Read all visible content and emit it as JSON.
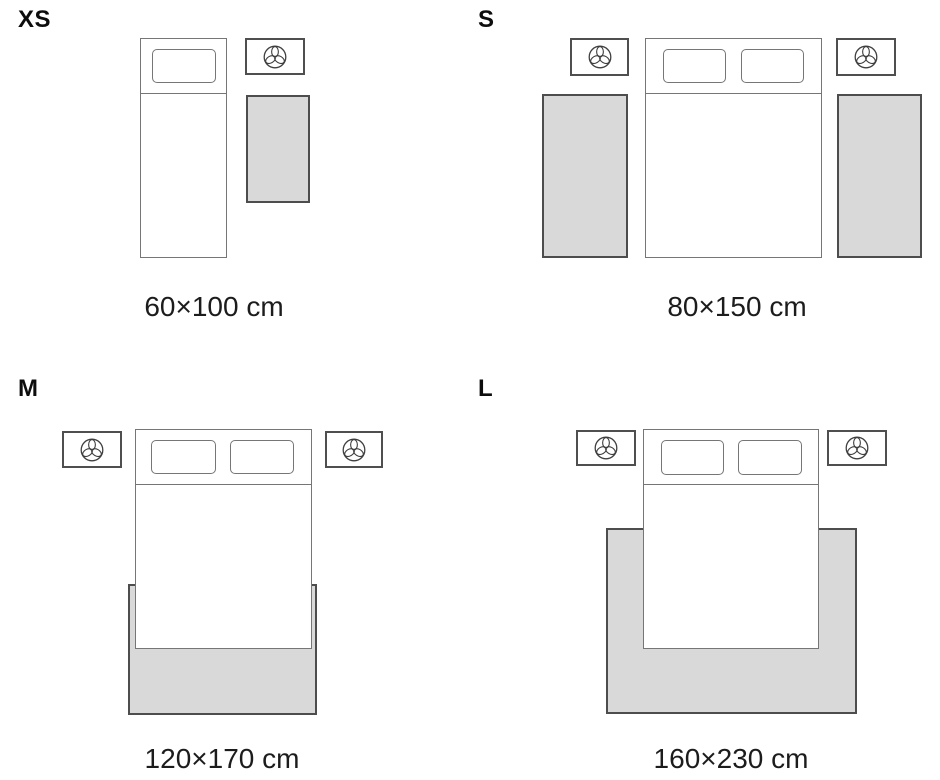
{
  "sizes": [
    {
      "id": "xs",
      "label": "XS",
      "dimensions": "60×100 cm",
      "bed_type": "single",
      "nightstands": 1,
      "rugs": 1,
      "rug_placement": "beside-bed"
    },
    {
      "id": "s",
      "label": "S",
      "dimensions": "80×150 cm",
      "bed_type": "double",
      "nightstands": 2,
      "rugs": 2,
      "rug_placement": "both-sides-of-bed"
    },
    {
      "id": "m",
      "label": "M",
      "dimensions": "120×170 cm",
      "bed_type": "double",
      "nightstands": 2,
      "rugs": 1,
      "rug_placement": "under-foot-of-bed"
    },
    {
      "id": "l",
      "label": "L",
      "dimensions": "160×230 cm",
      "bed_type": "double",
      "nightstands": 2,
      "rugs": 1,
      "rug_placement": "under-lower-two-thirds-of-bed"
    }
  ],
  "icons": {
    "nightstand": "plant-icon"
  },
  "colors": {
    "background": "#ffffff",
    "rug_fill": "#d9d9d9",
    "rug_border": "#4d4d4d",
    "bed_line": "#767676",
    "nightstand_border": "#4f4f4f",
    "icon_stroke": "#3f3f3f",
    "text": "#1c1c1c"
  }
}
